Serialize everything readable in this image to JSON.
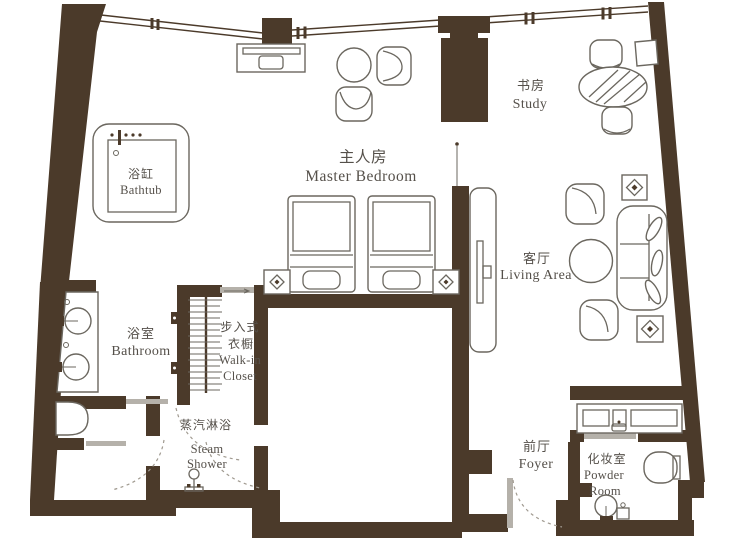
{
  "plan": {
    "rooms": {
      "bathtub": {
        "zh": "浴缸",
        "en": "Bathtub"
      },
      "bathroom": {
        "zh": "浴室",
        "en": "Bathroom"
      },
      "walk_in_closet": {
        "zh_line1": "步入式",
        "zh_line2": "衣橱",
        "en_line1": "Walk-in",
        "en_line2": "Closet"
      },
      "steam_shower": {
        "zh": "蒸汽淋浴",
        "en_line1": "Steam",
        "en_line2": "Shower"
      },
      "master_bedroom": {
        "zh": "主人房",
        "en": "Master Bedroom"
      },
      "study": {
        "zh": "书房",
        "en": "Study"
      },
      "living_area": {
        "zh": "客厅",
        "en": "Living Area"
      },
      "foyer": {
        "zh": "前厅",
        "en": "Foyer"
      },
      "powder_room": {
        "zh": "化妆室",
        "en_line1": "Powder",
        "en_line2": "Room"
      }
    },
    "colors": {
      "wall": "#4b3a2a",
      "line": "#6b675f",
      "leaf": "#b5b1aa",
      "arc": "#a09a90",
      "text": "#55504a",
      "bg": "#ffffff"
    }
  }
}
